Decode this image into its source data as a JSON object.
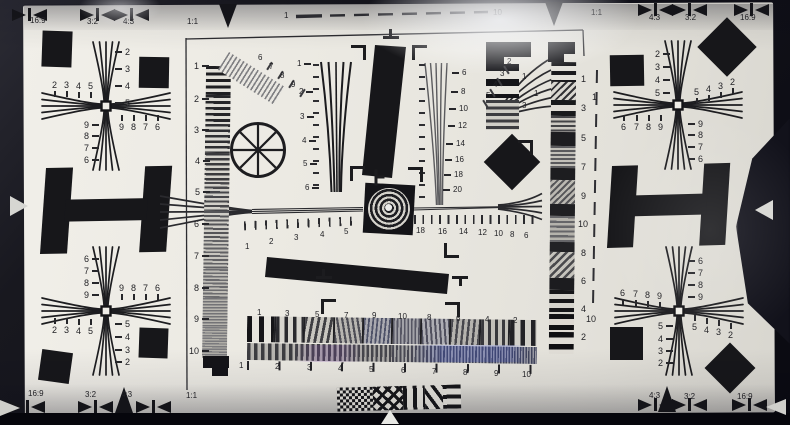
{
  "scene": {
    "description": "Photograph of an ISO 12233 camera resolution test chart",
    "paper_color": "#eae8e1",
    "background_color": "#12121a",
    "ink_color": "#1b1b1e"
  },
  "border": {
    "ruler": {
      "start": "1",
      "end": "10"
    },
    "top": [
      {
        "t": "16:9",
        "x": 30,
        "y": 17
      },
      {
        "t": "3:2",
        "x": 87,
        "y": 18
      },
      {
        "t": "4:3",
        "x": 123,
        "y": 18
      },
      {
        "t": "1:1",
        "x": 187,
        "y": 18
      },
      {
        "t": "1:1",
        "x": 591,
        "y": 9
      },
      {
        "t": "4:3",
        "x": 649,
        "y": 14
      },
      {
        "t": "3:2",
        "x": 685,
        "y": 14
      },
      {
        "t": "16:9",
        "x": 740,
        "y": 14
      }
    ],
    "bottom": [
      {
        "t": "16:9",
        "x": 28,
        "y": 390
      },
      {
        "t": "3:2",
        "x": 85,
        "y": 391
      },
      {
        "t": "4:3",
        "x": 121,
        "y": 391
      },
      {
        "t": "1:1",
        "x": 186,
        "y": 392
      },
      {
        "t": "4:3",
        "x": 649,
        "y": 392
      },
      {
        "t": "3:2",
        "x": 684,
        "y": 393
      },
      {
        "t": "16:9",
        "x": 737,
        "y": 393
      }
    ]
  },
  "corners": {
    "tl": {
      "h_outer": [
        {
          "t": "2",
          "x": 52,
          "y": 81
        },
        {
          "t": "3",
          "x": 64,
          "y": 81
        },
        {
          "t": "4",
          "x": 76,
          "y": 82
        },
        {
          "t": "5",
          "x": 88,
          "y": 82
        }
      ],
      "v_outer": [
        {
          "t": "2",
          "x": 125,
          "y": 48
        },
        {
          "t": "3",
          "x": 125,
          "y": 65
        },
        {
          "t": "4",
          "x": 125,
          "y": 82
        },
        {
          "t": "5",
          "x": 125,
          "y": 99
        }
      ],
      "h_inner": [
        {
          "t": "9",
          "x": 119,
          "y": 123
        },
        {
          "t": "8",
          "x": 131,
          "y": 123
        },
        {
          "t": "7",
          "x": 143,
          "y": 123
        },
        {
          "t": "6",
          "x": 155,
          "y": 123
        }
      ],
      "v_inner": [
        {
          "t": "9",
          "x": 84,
          "y": 121
        },
        {
          "t": "8",
          "x": 84,
          "y": 132
        },
        {
          "t": "7",
          "x": 84,
          "y": 144
        },
        {
          "t": "6",
          "x": 84,
          "y": 156
        }
      ]
    },
    "tr": {
      "h_outer": [
        {
          "t": "5",
          "x": 694,
          "y": 88
        },
        {
          "t": "4",
          "x": 706,
          "y": 85
        },
        {
          "t": "3",
          "x": 718,
          "y": 82
        },
        {
          "t": "2",
          "x": 730,
          "y": 78
        }
      ],
      "v_outer": [
        {
          "t": "2",
          "x": 655,
          "y": 50
        },
        {
          "t": "3",
          "x": 655,
          "y": 63
        },
        {
          "t": "4",
          "x": 655,
          "y": 76
        },
        {
          "t": "5",
          "x": 655,
          "y": 89
        }
      ],
      "h_inner": [
        {
          "t": "6",
          "x": 621,
          "y": 123
        },
        {
          "t": "7",
          "x": 634,
          "y": 123
        },
        {
          "t": "8",
          "x": 646,
          "y": 123
        },
        {
          "t": "9",
          "x": 658,
          "y": 123
        }
      ],
      "v_inner": [
        {
          "t": "9",
          "x": 698,
          "y": 120
        },
        {
          "t": "8",
          "x": 698,
          "y": 131
        },
        {
          "t": "7",
          "x": 698,
          "y": 143
        },
        {
          "t": "6",
          "x": 698,
          "y": 155
        }
      ]
    },
    "bl": {
      "h_outer": [
        {
          "t": "2",
          "x": 52,
          "y": 326
        },
        {
          "t": "3",
          "x": 64,
          "y": 326
        },
        {
          "t": "4",
          "x": 76,
          "y": 327
        },
        {
          "t": "5",
          "x": 88,
          "y": 327
        }
      ],
      "v_outer": [
        {
          "t": "5",
          "x": 125,
          "y": 320
        },
        {
          "t": "4",
          "x": 125,
          "y": 333
        },
        {
          "t": "3",
          "x": 125,
          "y": 346
        },
        {
          "t": "2",
          "x": 125,
          "y": 358
        }
      ],
      "h_inner": [
        {
          "t": "9",
          "x": 119,
          "y": 284
        },
        {
          "t": "8",
          "x": 131,
          "y": 284
        },
        {
          "t": "7",
          "x": 143,
          "y": 284
        },
        {
          "t": "6",
          "x": 155,
          "y": 284
        }
      ],
      "v_inner": [
        {
          "t": "6",
          "x": 84,
          "y": 255
        },
        {
          "t": "7",
          "x": 84,
          "y": 267
        },
        {
          "t": "8",
          "x": 84,
          "y": 279
        },
        {
          "t": "9",
          "x": 84,
          "y": 291
        }
      ]
    },
    "br": {
      "h_outer": [
        {
          "t": "5",
          "x": 692,
          "y": 323
        },
        {
          "t": "4",
          "x": 704,
          "y": 326
        },
        {
          "t": "3",
          "x": 716,
          "y": 328
        },
        {
          "t": "2",
          "x": 728,
          "y": 331
        }
      ],
      "v_outer": [
        {
          "t": "5",
          "x": 658,
          "y": 322
        },
        {
          "t": "4",
          "x": 658,
          "y": 335
        },
        {
          "t": "3",
          "x": 658,
          "y": 347
        },
        {
          "t": "2",
          "x": 658,
          "y": 359
        }
      ],
      "h_inner": [
        {
          "t": "6",
          "x": 620,
          "y": 289
        },
        {
          "t": "7",
          "x": 633,
          "y": 290
        },
        {
          "t": "8",
          "x": 645,
          "y": 291
        },
        {
          "t": "9",
          "x": 657,
          "y": 292
        }
      ],
      "v_inner": [
        {
          "t": "6",
          "x": 698,
          "y": 257
        },
        {
          "t": "7",
          "x": 698,
          "y": 269
        },
        {
          "t": "8",
          "x": 698,
          "y": 281
        },
        {
          "t": "9",
          "x": 698,
          "y": 293
        }
      ]
    }
  },
  "center": {
    "left_ruler": [
      {
        "t": "1",
        "x": 194,
        "y": 62
      },
      {
        "t": "2",
        "x": 194,
        "y": 95
      },
      {
        "t": "3",
        "x": 194,
        "y": 126
      },
      {
        "t": "4",
        "x": 195,
        "y": 157
      },
      {
        "t": "5",
        "x": 195,
        "y": 188
      },
      {
        "t": "6",
        "x": 194,
        "y": 220
      },
      {
        "t": "7",
        "x": 194,
        "y": 252
      },
      {
        "t": "8",
        "x": 194,
        "y": 284
      },
      {
        "t": "9",
        "x": 194,
        "y": 315
      },
      {
        "t": "10",
        "x": 189,
        "y": 347
      }
    ],
    "right_strip": [
      {
        "t": "1",
        "x": 581,
        "y": 75
      },
      {
        "t": "3",
        "x": 581,
        "y": 104
      },
      {
        "t": "5",
        "x": 581,
        "y": 134
      },
      {
        "t": "7",
        "x": 581,
        "y": 163
      },
      {
        "t": "9",
        "x": 581,
        "y": 192
      },
      {
        "t": "10",
        "x": 578,
        "y": 220
      },
      {
        "t": "8",
        "x": 581,
        "y": 249
      },
      {
        "t": "6",
        "x": 581,
        "y": 277
      },
      {
        "t": "4",
        "x": 581,
        "y": 305
      },
      {
        "t": "2",
        "x": 581,
        "y": 333
      }
    ],
    "right_dashed": [
      {
        "t": "1",
        "x": 592,
        "y": 93
      },
      {
        "t": "10",
        "x": 586,
        "y": 315
      }
    ],
    "v_scale_left": [
      {
        "t": "1",
        "x": 297,
        "y": 60
      },
      {
        "t": "2",
        "x": 299,
        "y": 88
      },
      {
        "t": "3",
        "x": 300,
        "y": 113
      },
      {
        "t": "4",
        "x": 302,
        "y": 137
      },
      {
        "t": "5",
        "x": 303,
        "y": 160
      },
      {
        "t": "6",
        "x": 305,
        "y": 184
      }
    ],
    "v_scale_right": [
      {
        "t": "6",
        "x": 462,
        "y": 69
      },
      {
        "t": "8",
        "x": 461,
        "y": 88
      },
      {
        "t": "10",
        "x": 459,
        "y": 105
      },
      {
        "t": "12",
        "x": 458,
        "y": 122
      },
      {
        "t": "14",
        "x": 456,
        "y": 140
      },
      {
        "t": "16",
        "x": 455,
        "y": 156
      },
      {
        "t": "18",
        "x": 454,
        "y": 171
      },
      {
        "t": "20",
        "x": 453,
        "y": 186
      }
    ],
    "diag_labels": [
      {
        "t": "6",
        "x": 258,
        "y": 54
      },
      {
        "t": "7",
        "x": 269,
        "y": 63
      },
      {
        "t": "8",
        "x": 280,
        "y": 72
      },
      {
        "t": "9",
        "x": 291,
        "y": 81
      }
    ],
    "fan_labels": [
      {
        "t": "2",
        "x": 507,
        "y": 58
      },
      {
        "t": "3",
        "x": 500,
        "y": 70
      },
      {
        "t": "4",
        "x": 493,
        "y": 81
      },
      {
        "t": "5",
        "x": 486,
        "y": 92
      }
    ],
    "h_ruler_left": [
      {
        "t": "1",
        "x": 245,
        "y": 243
      },
      {
        "t": "2",
        "x": 269,
        "y": 238
      },
      {
        "t": "3",
        "x": 294,
        "y": 234
      },
      {
        "t": "4",
        "x": 320,
        "y": 231
      },
      {
        "t": "5",
        "x": 344,
        "y": 228
      }
    ],
    "h_ruler_right": [
      {
        "t": "18",
        "x": 416,
        "y": 227
      },
      {
        "t": "16",
        "x": 438,
        "y": 228
      },
      {
        "t": "14",
        "x": 459,
        "y": 228
      },
      {
        "t": "12",
        "x": 478,
        "y": 229
      },
      {
        "t": "10",
        "x": 494,
        "y": 230
      },
      {
        "t": "8",
        "x": 510,
        "y": 231
      },
      {
        "t": "6",
        "x": 524,
        "y": 232
      }
    ],
    "bars_labels": [
      {
        "t": "1",
        "x": 522,
        "y": 73
      },
      {
        "t": "1",
        "x": 534,
        "y": 90
      },
      {
        "t": "3",
        "x": 522,
        "y": 102
      }
    ],
    "sweep_top": [
      {
        "t": "1",
        "x": 257,
        "y": 309
      },
      {
        "t": "3",
        "x": 285,
        "y": 310
      },
      {
        "t": "5",
        "x": 315,
        "y": 311
      },
      {
        "t": "7",
        "x": 344,
        "y": 312
      },
      {
        "t": "9",
        "x": 372,
        "y": 312
      },
      {
        "t": "10",
        "x": 398,
        "y": 313
      },
      {
        "t": "8",
        "x": 427,
        "y": 314
      },
      {
        "t": "6",
        "x": 456,
        "y": 315
      },
      {
        "t": "4",
        "x": 485,
        "y": 316
      },
      {
        "t": "2",
        "x": 513,
        "y": 317
      }
    ],
    "sweep_bottom": [
      {
        "t": "1",
        "x": 239,
        "y": 362
      },
      {
        "t": "2",
        "x": 275,
        "y": 363
      },
      {
        "t": "3",
        "x": 307,
        "y": 364
      },
      {
        "t": "4",
        "x": 338,
        "y": 365
      },
      {
        "t": "5",
        "x": 369,
        "y": 366
      },
      {
        "t": "6",
        "x": 401,
        "y": 367
      },
      {
        "t": "7",
        "x": 432,
        "y": 368
      },
      {
        "t": "8",
        "x": 463,
        "y": 369
      },
      {
        "t": "9",
        "x": 494,
        "y": 370
      },
      {
        "t": "10",
        "x": 522,
        "y": 371
      }
    ]
  }
}
